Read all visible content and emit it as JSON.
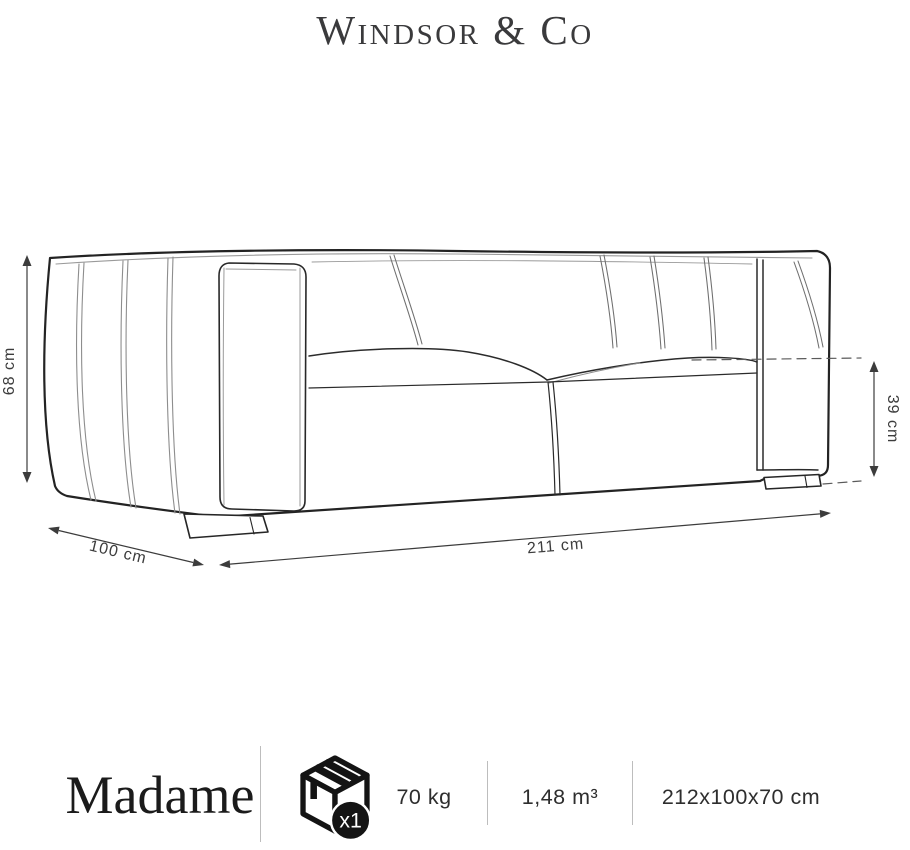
{
  "brand": {
    "name": "Windsor & Co"
  },
  "diagram": {
    "back_height": "68 cm",
    "seat_height": "39 cm",
    "depth": "100 cm",
    "width": "211 cm"
  },
  "footer": {
    "product_name": "Madame",
    "package_count": "x1",
    "weight": "70 kg",
    "volume": "1,48 m³",
    "packaging_dimensions": "212x100x70 cm"
  },
  "colors": {
    "ink": "#1f1f1f",
    "outline": "#232323",
    "seam_gray": "#8d8d8d",
    "dimension": "#3c3c3c",
    "divider": "#bdbdbd",
    "badge": "#141414",
    "background": "#ffffff"
  }
}
